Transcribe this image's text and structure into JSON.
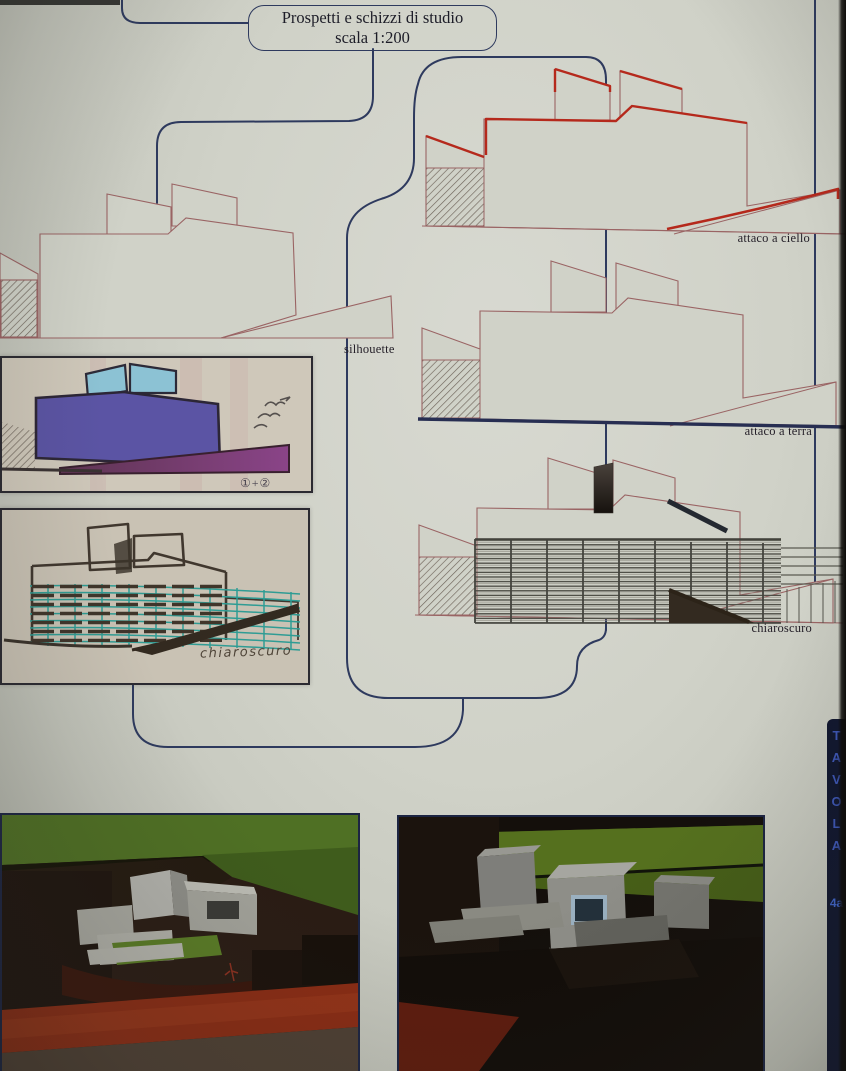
{
  "title": {
    "line1": "Prospetti e schizzi di studio",
    "line2": "scala 1:200"
  },
  "labels": {
    "silhouette": "silhouette",
    "attaco_ciello": "attaco a ciello",
    "attaco_terra": "attaco a terra",
    "chiaroscuro": "chiaroscuro",
    "sketch_chiaroscuro": "chiaroscuro",
    "sketch_sum": "①+②"
  },
  "tavola": {
    "label": "TAVOLA",
    "number": "4a"
  },
  "colors": {
    "flowchart_navy": "#2e3a5e",
    "outline_maroon": "#9a6464",
    "accent_red": "#b5291c",
    "accent_ground_navy": "#272e52",
    "paper": "#d0d2c8",
    "strip_bg": "#10162e",
    "strip_text": "#3c55b4"
  }
}
